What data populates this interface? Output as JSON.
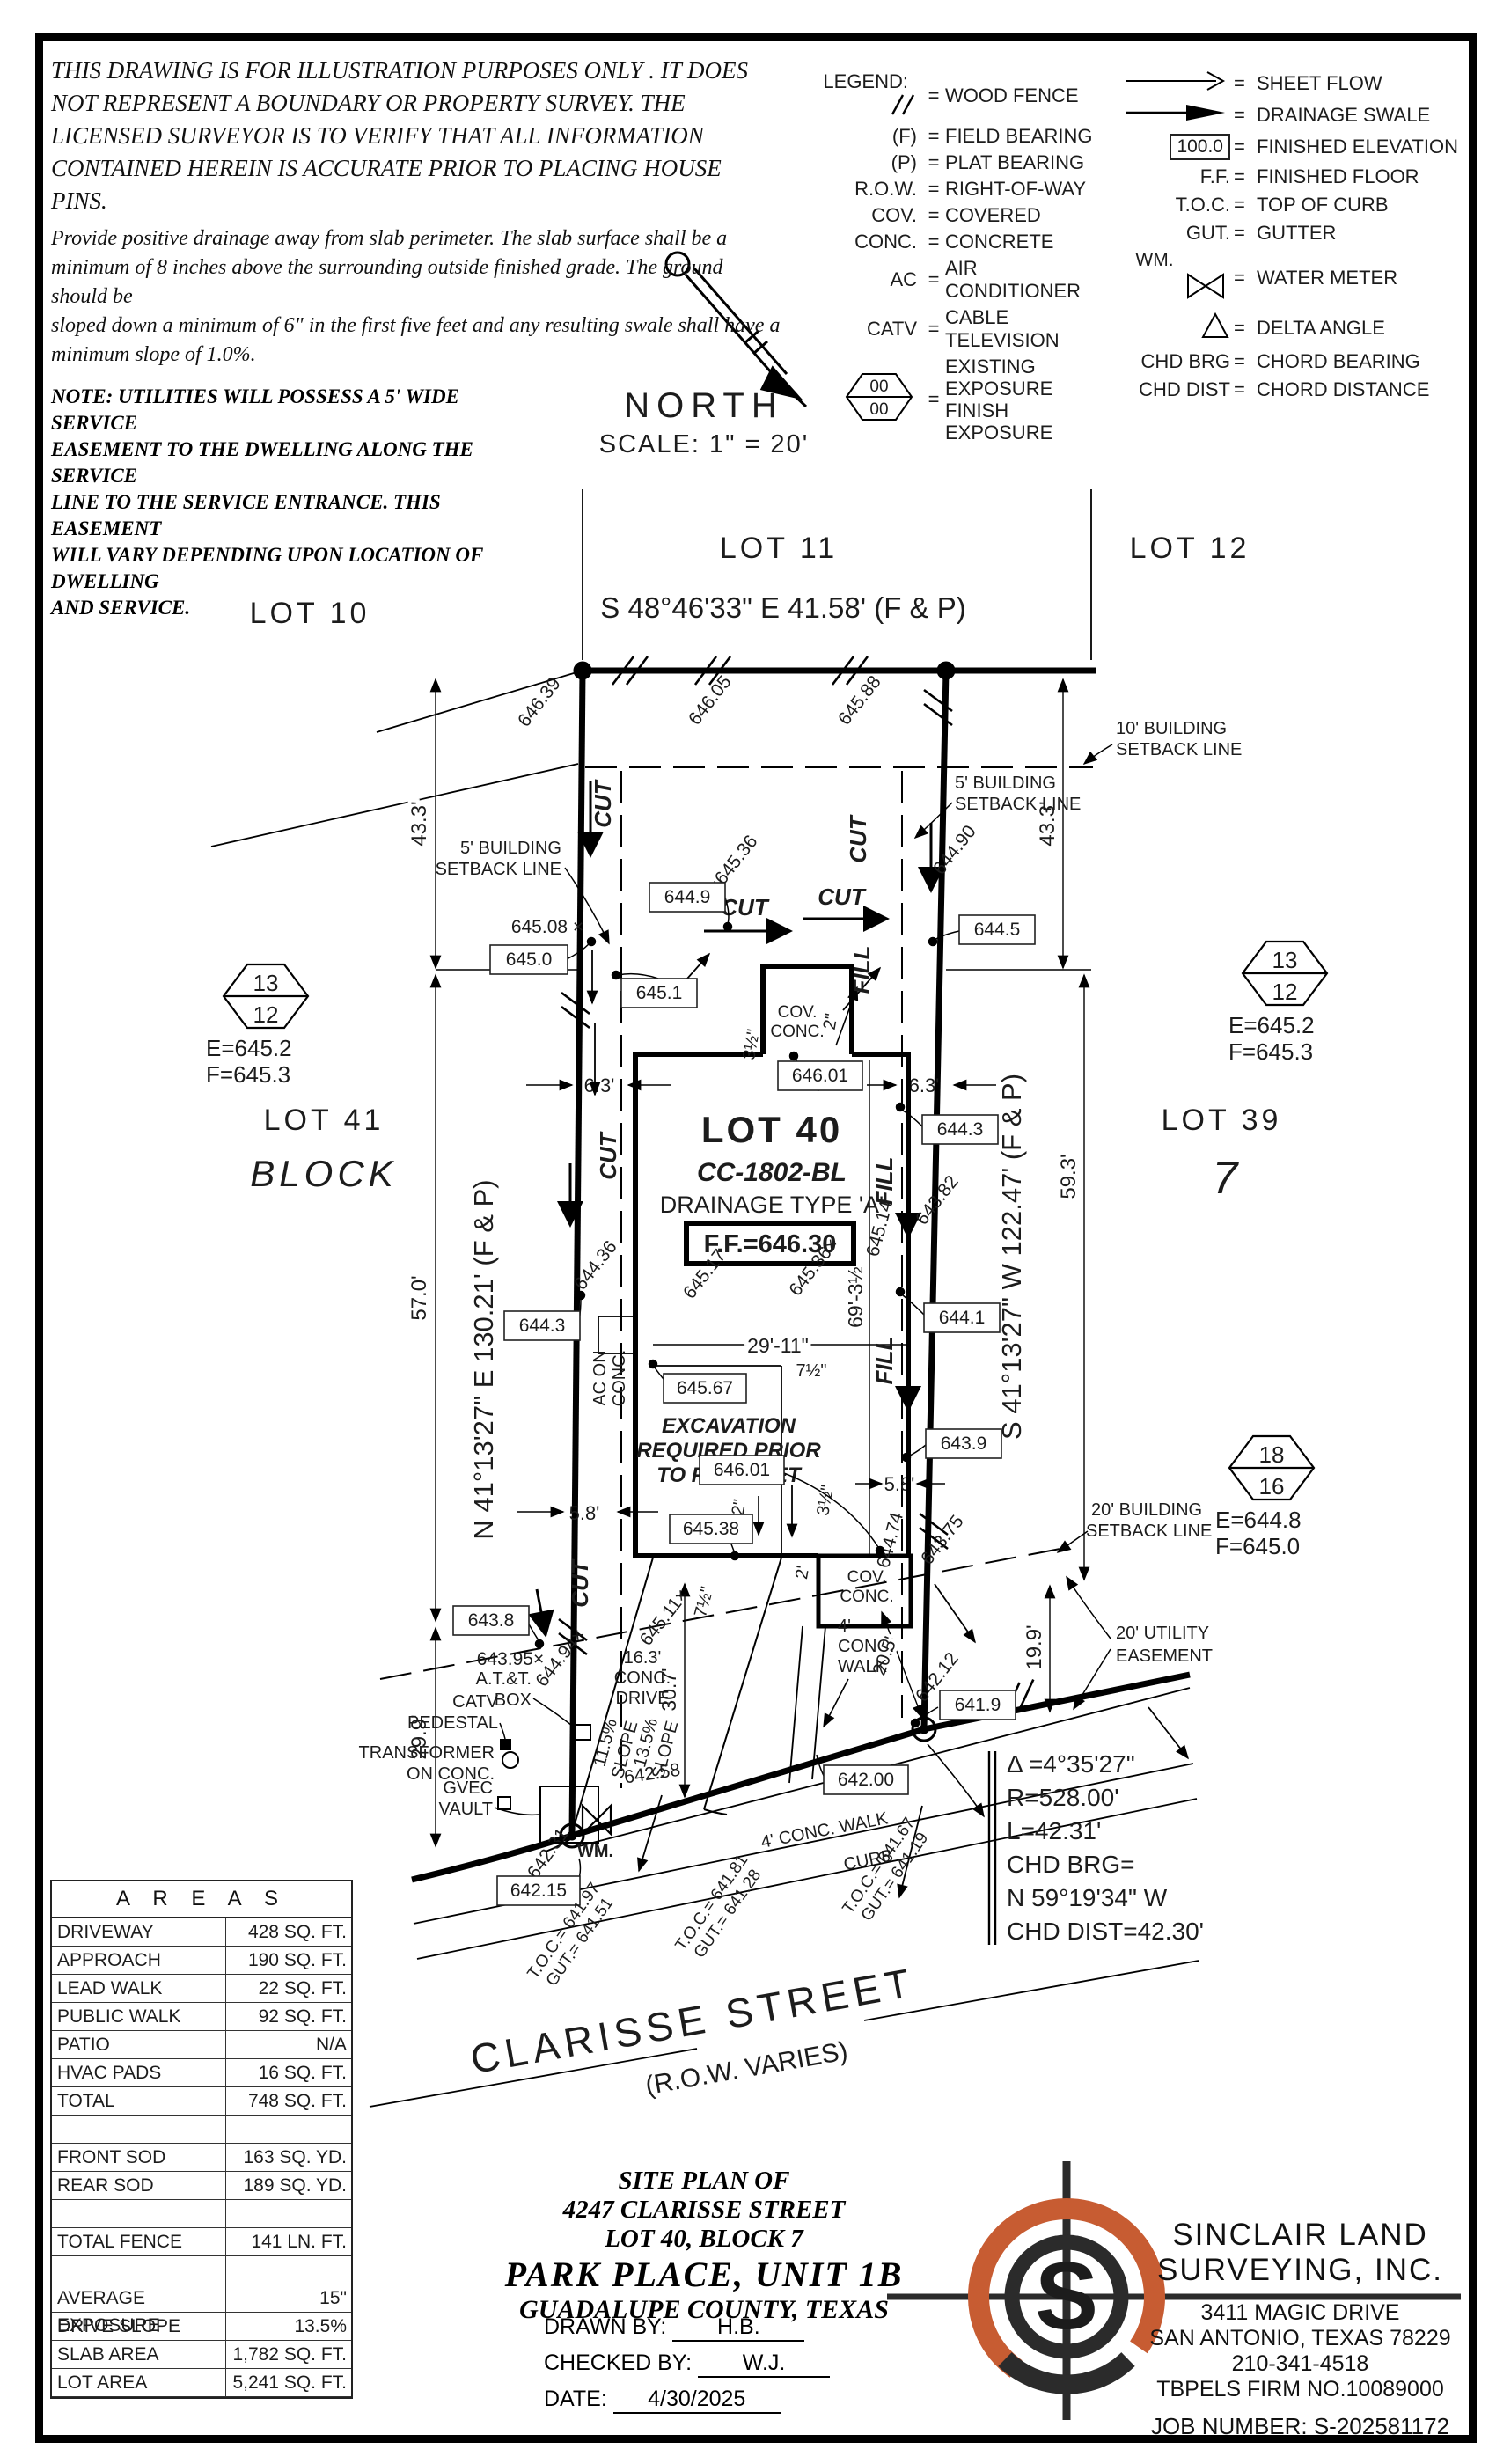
{
  "ui": {
    "eq": "="
  },
  "disclaimer": {
    "p1": "THIS DRAWING IS FOR ILLUSTRATION PURPOSES ONLY . IT DOES\nNOT REPRESENT A BOUNDARY OR PROPERTY SURVEY. THE\nLICENSED SURVEYOR IS TO VERIFY THAT ALL INFORMATION\nCONTAINED HEREIN IS ACCURATE PRIOR TO PLACING HOUSE PINS.",
    "p2": "Provide positive drainage away from slab perimeter. The slab surface shall be a\nminimum of 8 inches above the surrounding outside finished grade. The ground should be\nsloped down a minimum of 6\" in the first five feet and any resulting swale shall have a\nminimum slope of 1.0%.",
    "note": "NOTE:  UTILITIES  WILL  POSSESS  A  5'  WIDE  SERVICE\nEASEMENT  TO  THE  DWELLING  ALONG  THE  SERVICE\nLINE  TO  THE  SERVICE  ENTRANCE.  THIS  EASEMENT\nWILL  VARY  DEPENDING  UPON  LOCATION  OF  DWELLING\nAND  SERVICE."
  },
  "legend": {
    "title": "LEGEND:",
    "left": [
      {
        "sym": "",
        "label": "WOOD FENCE"
      },
      {
        "sym": "(F)",
        "label": "FIELD BEARING"
      },
      {
        "sym": "(P)",
        "label": "PLAT BEARING"
      },
      {
        "sym": "R.O.W.",
        "label": "RIGHT-OF-WAY"
      },
      {
        "sym": "COV.",
        "label": "COVERED"
      },
      {
        "sym": "CONC.",
        "label": "CONCRETE"
      },
      {
        "sym": "AC",
        "label": "AIR CONDITIONER"
      },
      {
        "sym": "CATV",
        "label": "CABLE TELEVISION"
      }
    ],
    "exposure": {
      "top": "00",
      "bottom": "00",
      "l1": "EXISTING EXPOSURE",
      "l2": "FINISH EXPOSURE"
    },
    "right": [
      {
        "sym": "",
        "label": "SHEET FLOW"
      },
      {
        "sym": "",
        "label": "DRAINAGE SWALE"
      },
      {
        "sym": "100.0",
        "label": "FINISHED ELEVATION"
      },
      {
        "sym": "F.F.",
        "label": "FINISHED FLOOR"
      },
      {
        "sym": "T.O.C.",
        "label": "TOP OF CURB"
      },
      {
        "sym": "GUT.",
        "label": "GUTTER"
      },
      {
        "sym": "WM.",
        "label": "WATER METER"
      },
      {
        "sym": "",
        "label": "DELTA ANGLE"
      },
      {
        "sym": "CHD BRG",
        "label": "CHORD BEARING"
      },
      {
        "sym": "CHD DIST",
        "label": "CHORD DISTANCE"
      }
    ]
  },
  "north": {
    "label": "NORTH",
    "scale": "SCALE:  1\" = 20'"
  },
  "plat": {
    "lot10": "LOT 10",
    "lot11": "LOT 11",
    "lot12": "LOT 12",
    "lot41": "LOT 41",
    "lot39": "LOT 39",
    "block_word": "BLOCK",
    "block_num": "7",
    "brg_top": "S 48°46'33\" E 41.58' (F & P)",
    "brg_left": "N 41°13'27\" E 130.21' (F & P)",
    "brg_right": "S 41°13'27\" W 122.47' (F & P)",
    "lot40": "LOT 40",
    "model": "CC-1802-BL",
    "drainage": "DRAINAGE TYPE 'A'",
    "ff": "F.F.=646.30",
    "exc1": "EXCAVATION",
    "exc2": "REQUIRED PRIOR",
    "exc3": "TO FROM SET",
    "sb5a": "5' BUILDING",
    "sb5b": "SETBACK LINE",
    "sb10a": "10' BUILDING",
    "sb10b": "SETBACK LINE",
    "sb20a": "20' BUILDING",
    "sb20b": "SETBACK LINE",
    "ue1": "20' UTILITY",
    "ue2": "EASEMENT",
    "d433": "43.3'",
    "d570": "57.0'",
    "d299": "29.9'",
    "d593": "59.3'",
    "d199": "19.9'",
    "d63": "6.3'",
    "d58": "5.8'",
    "d205": "20.5'",
    "d2911": "29'-11\"",
    "d693": "69'-3½\"",
    "d307": "30.7'",
    "dr1": "16.3'",
    "dr2": "CONC.",
    "dr3": "DRIVE",
    "sl115": "11.5%",
    "sl135": "13.5%",
    "slw": "SLOPE",
    "lw1": "4'",
    "lw2": "CONC.",
    "lw3": "WALK",
    "walk_street": "4' CONC. WALK",
    "curb": "CURB",
    "acon1": "AC ON",
    "acon2": "CONC.",
    "att1": "A.T.&T.",
    "att2": "BOX",
    "catv1": "CATV",
    "catv2": "PEDESTAL",
    "xf1": "TRANSFORMER",
    "xf2": "ON CONC.",
    "gv1": "GVEC",
    "gv2": "VAULT",
    "wm": "WM.",
    "cov1": "COV.",
    "cov2": "CONC.",
    "in2": "2\"",
    "ft2": "2'",
    "in35": "3½\"",
    "in75": "7½\"",
    "cut": "CUT",
    "fill": "FILL",
    "h13": "13",
    "h12": "12",
    "h18": "18",
    "h16": "16",
    "ef1e": "E=645.2",
    "ef1f": "F=645.3",
    "ef2e": "E=644.8",
    "ef2f": "F=645.0",
    "eb": [
      "645.0",
      "645.1",
      "644.9",
      "644.5",
      "646.01",
      "644.3",
      "644.3",
      "644.1",
      "643.9",
      "645.67",
      "646.01",
      "645.38",
      "643.8",
      "641.9",
      "642.00",
      "642.15"
    ],
    "sp0": "646.39",
    "sp1": "646.05",
    "sp2": "645.88",
    "sp3": "644.90",
    "sp4": "645.08 ×",
    "sp5": "×645.36",
    "sp6": "645.17",
    "sp7": "645.36×",
    "sp8": "644.36",
    "sp9": "645.14",
    "sp10": "643.82",
    "sp11": "644.74",
    "sp12": "643.75",
    "sp13": "642.12",
    "sp14": "644.94×",
    "sp15": "643.95×",
    "sp16": "645.11×",
    "sp17": "642.31",
    "sp18": "642.58",
    "t1a": "T.O.C.= 641.97",
    "t1b": "GUT.= 641.51",
    "t2a": "T.O.C.= 641.81",
    "t2b": "GUT.= 641.28",
    "t3a": "T.O.C.= 641.67",
    "t3b": "GUT.= 641.19",
    "cv1": "Δ =4°35'27\"",
    "cv2": "R=528.00'",
    "cv3": "L=42.31'",
    "cv4": "CHD BRG=",
    "cv5": "N 59°19'34\" W",
    "cv6": "CHD DIST=42.30'",
    "st1": "CLARISSE STREET",
    "st2": "(R.O.W. VARIES)"
  },
  "areas": {
    "title": "A R E A S",
    "rows": [
      {
        "label": "DRIVEWAY",
        "value": "428 SQ. FT."
      },
      {
        "label": "APPROACH",
        "value": "190 SQ. FT."
      },
      {
        "label": "LEAD WALK",
        "value": "22 SQ. FT."
      },
      {
        "label": "PUBLIC WALK",
        "value": "92 SQ. FT."
      },
      {
        "label": "PATIO",
        "value": "N/A"
      },
      {
        "label": "HVAC PADS",
        "value": "16 SQ. FT."
      },
      {
        "label": "TOTAL",
        "value": "748 SQ. FT."
      },
      {
        "label": "",
        "value": ""
      },
      {
        "label": "FRONT SOD",
        "value": "163 SQ. YD."
      },
      {
        "label": "REAR SOD",
        "value": "189 SQ. YD."
      },
      {
        "label": "",
        "value": ""
      },
      {
        "label": "TOTAL FENCE",
        "value": "141 LN. FT."
      },
      {
        "label": "",
        "value": ""
      },
      {
        "label": "AVERAGE EXPOSURE",
        "value": "15\""
      },
      {
        "label": "DRIVE SLOPE",
        "value": "13.5%"
      },
      {
        "label": "SLAB AREA",
        "value": "1,782 SQ. FT."
      },
      {
        "label": "LOT AREA",
        "value": "5,241 SQ. FT."
      }
    ]
  },
  "titleblock": {
    "l1": "SITE PLAN OF",
    "l2": "4247 CLARISSE STREET",
    "l3": "LOT 40, BLOCK 7",
    "l4": "PARK PLACE, UNIT 1B",
    "l5": "GUADALUPE COUNTY, TEXAS",
    "drawn_label": "DRAWN BY:",
    "drawn": "H.B.",
    "checked_label": "CHECKED BY:",
    "checked": "W.J.",
    "date_label": "DATE:",
    "date": "4/30/2025"
  },
  "firm": {
    "name1": "SINCLAIR LAND",
    "name2": "SURVEYING, INC.",
    "addr1": "3411 MAGIC DRIVE",
    "addr2": "SAN ANTONIO, TEXAS 78229",
    "phone": "210-341-4518",
    "firm_no": "TBPELS FIRM NO.10089000",
    "job": "JOB NUMBER:  S-202581172",
    "orange": "#c75c32",
    "dark": "#2b2b2b"
  }
}
